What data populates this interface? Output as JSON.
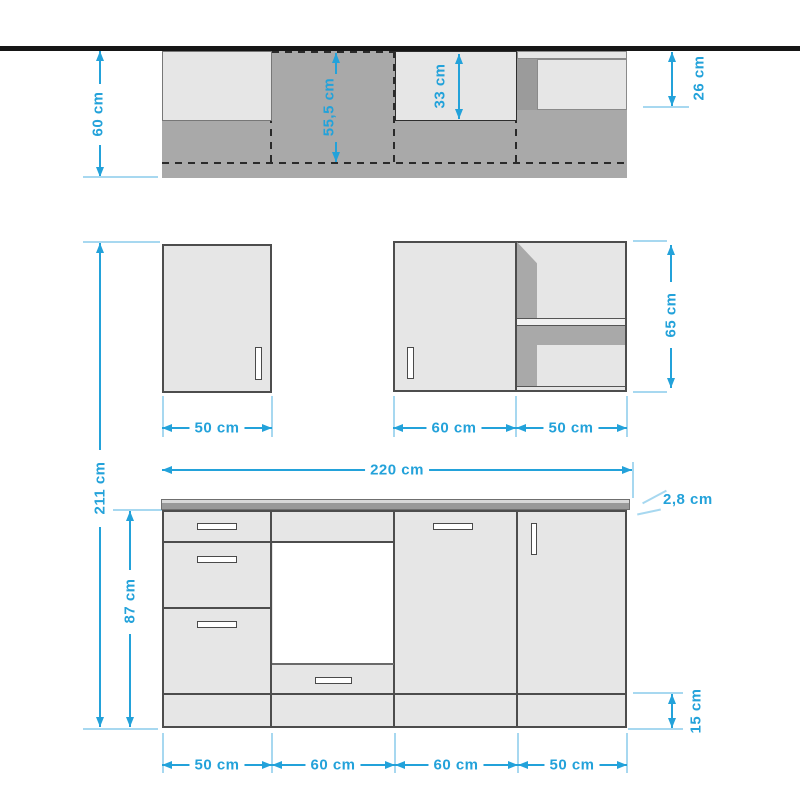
{
  "colors": {
    "dimension_blue": "#23A2DA",
    "extension_blue": "#A7D8F0",
    "panel_light": "#E6E6E6",
    "body_gray": "#A9A9A9",
    "band_gray": "#9B9B9B",
    "worktop_gray": "#999999",
    "outline_dark": "#4D4D4D",
    "wall_black": "#161616"
  },
  "plan_view": {
    "depth_total": "60 cm",
    "carcass_depth": "55,5 cm",
    "mid_upper_depth": "33 cm",
    "right_upper_depth": "26 cm"
  },
  "wall_units": {
    "left_width": "50 cm",
    "mid_width": "60 cm",
    "right_width": "50 cm",
    "height": "65 cm"
  },
  "base_units": {
    "total_width": "220 cm",
    "worktop_thickness": "2,8 cm",
    "total_height": "211 cm",
    "base_height": "87 cm",
    "plinth_height": "15 cm",
    "section_widths": [
      "50 cm",
      "60 cm",
      "60 cm",
      "50 cm"
    ]
  }
}
